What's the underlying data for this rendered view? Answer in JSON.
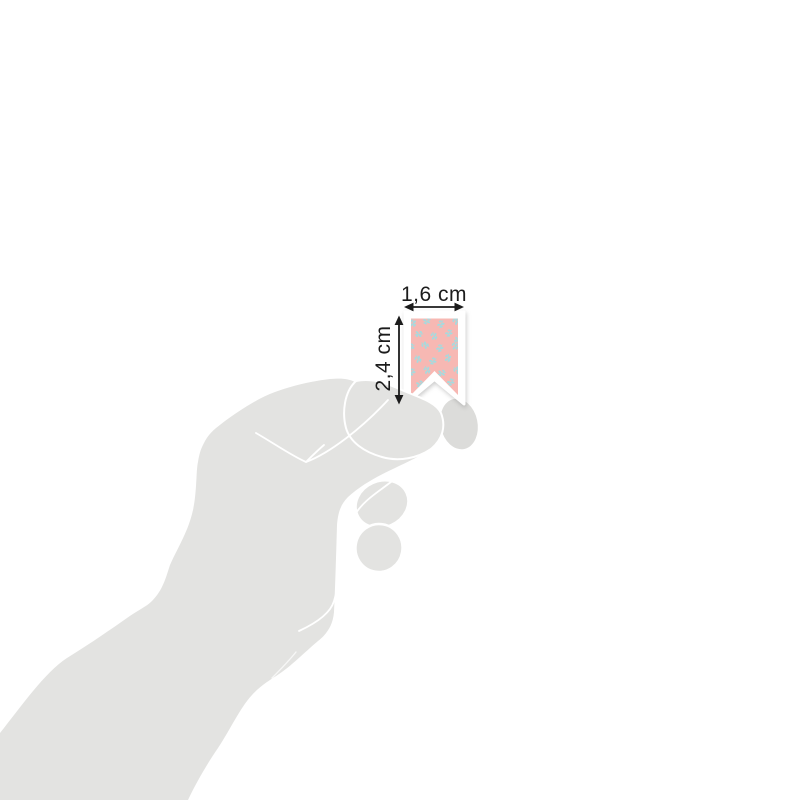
{
  "dimensions": {
    "width_label": "1,6 cm",
    "height_label": "2,4 cm"
  },
  "colors": {
    "background": "#ffffff",
    "hand": "#e3e3e1",
    "hand_shadow": "#dcdcda",
    "crease": "#ffffff",
    "sticker_base": "#ffffff",
    "sticker_pink": "#f7b8b3",
    "leaf_teal": "#a6dade",
    "annotation": "#1c1c1c"
  },
  "sticker": {
    "shape": "swallowtail-pennant",
    "pattern": {
      "motif": "leaf-sprig",
      "positions": [
        [
          413,
          323,
          -20
        ],
        [
          427,
          321,
          50
        ],
        [
          441,
          324,
          10
        ],
        [
          456,
          321,
          -60
        ],
        [
          419,
          334,
          70
        ],
        [
          434,
          336,
          -35
        ],
        [
          449,
          333,
          25
        ],
        [
          458,
          340,
          80
        ],
        [
          411,
          347,
          40
        ],
        [
          425,
          345,
          -75
        ],
        [
          440,
          348,
          15
        ],
        [
          455,
          346,
          -30
        ],
        [
          418,
          359,
          -50
        ],
        [
          433,
          361,
          35
        ],
        [
          448,
          358,
          -10
        ],
        [
          412,
          372,
          20
        ],
        [
          427,
          370,
          -40
        ],
        [
          442,
          373,
          60
        ],
        [
          457,
          370,
          -70
        ],
        [
          420,
          384,
          45
        ],
        [
          436,
          386,
          -15
        ],
        [
          451,
          382,
          30
        ],
        [
          429,
          392,
          -55
        ],
        [
          444,
          391,
          70
        ]
      ]
    }
  }
}
